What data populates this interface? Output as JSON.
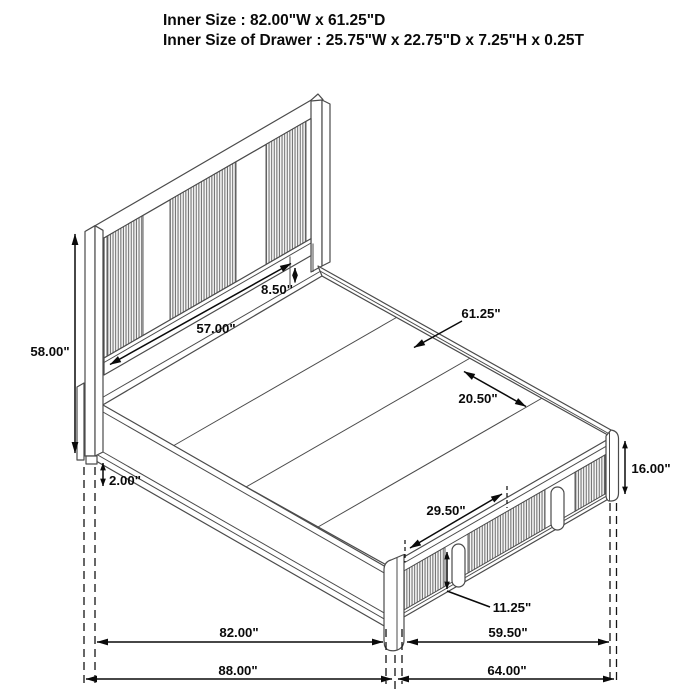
{
  "header": {
    "line1": "Inner Size : 82.00\"W x 61.25\"D",
    "line2": "Inner Size of Drawer : 25.75\"W x 22.75\"D x 7.25\"H x 0.25T"
  },
  "dimensions": {
    "bed_height": "58.00\"",
    "headboard_panel_width": "57.00\"",
    "headboard_clearance": "8.50\"",
    "platform_depth": "61.25\"",
    "panel_spacing": "20.50\"",
    "base_height": "16.00\"",
    "rail_thickness": "2.00\"",
    "drawer_width": "29.50\"",
    "drawer_height": "11.25\"",
    "inner_width": "82.00\"",
    "side_depth": "59.50\"",
    "overall_width": "88.00\"",
    "overall_depth": "64.00\""
  }
}
